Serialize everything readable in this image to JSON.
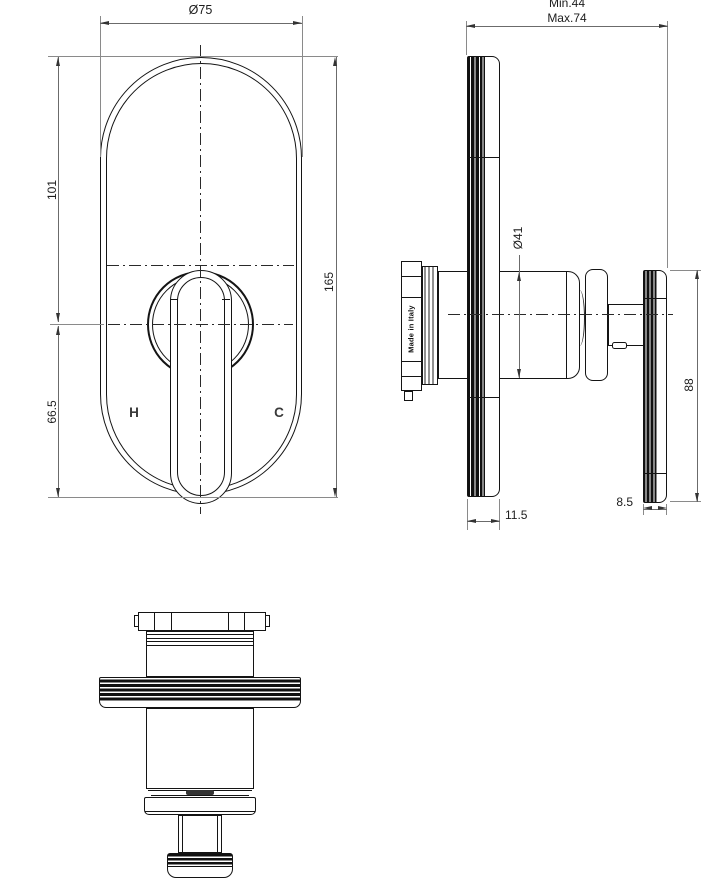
{
  "drawing": {
    "front_view": {
      "dim_plate_width": "Ø75",
      "dim_top_to_handle_center": "101",
      "dim_handle_center_to_bottom": "66.5",
      "dim_plate_height": "165",
      "hot_label": "H",
      "cold_label": "C"
    },
    "side_view": {
      "dim_wall_depth_min": "Min.44",
      "dim_wall_depth_max": "Max.74",
      "dim_body_diameter": "Ø41",
      "made_in_label": "Made in Italy",
      "dim_handle_height": "88",
      "dim_plate_thickness": "11.5",
      "dim_handle_thickness": "8.5"
    }
  },
  "colors": {
    "object_line": "#141414",
    "dimension_line": "#6b6b6b",
    "text": "#222222",
    "background": "#ffffff"
  }
}
